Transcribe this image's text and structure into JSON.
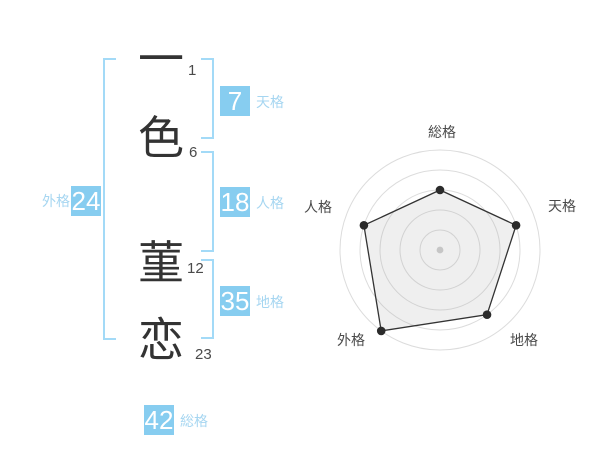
{
  "colors": {
    "badge_blue": "#87cdf0",
    "label_blue": "#a6d6f1",
    "bracket_blue": "#a3daf7",
    "text_dark": "#333333",
    "stroke_number_gray": "#4a4a4a",
    "grid_gray": "#dcdcdc",
    "polygon_line": "#333333",
    "polygon_fill": "rgba(165,165,165,0.18)",
    "dot_dark": "#2b2b2b",
    "center_dot_gray": "#c6c6c6",
    "axis_label_gray": "#4a4a4a"
  },
  "name": {
    "characters": [
      {
        "char": "一",
        "strokes": "1"
      },
      {
        "char": "色",
        "strokes": "6"
      },
      {
        "char": "菫",
        "strokes": "12"
      },
      {
        "char": "恋",
        "strokes": "23"
      }
    ]
  },
  "kaku": {
    "tenkaku": {
      "value": "7",
      "label": "天格"
    },
    "jinkaku": {
      "value": "18",
      "label": "人格"
    },
    "chikaku": {
      "value": "35",
      "label": "地格"
    },
    "gaikaku": {
      "value": "24",
      "label": "外格"
    },
    "soukaku": {
      "value": "42",
      "label": "総格"
    }
  },
  "chart_data": {
    "type": "radar",
    "title": "",
    "categories": [
      "総格",
      "天格",
      "地格",
      "外格",
      "人格"
    ],
    "values": [
      3,
      4,
      4,
      5,
      4
    ],
    "value_max": 5,
    "grid_rings": 5,
    "start_angle_deg": -90,
    "direction": "clockwise",
    "legend": "none"
  }
}
